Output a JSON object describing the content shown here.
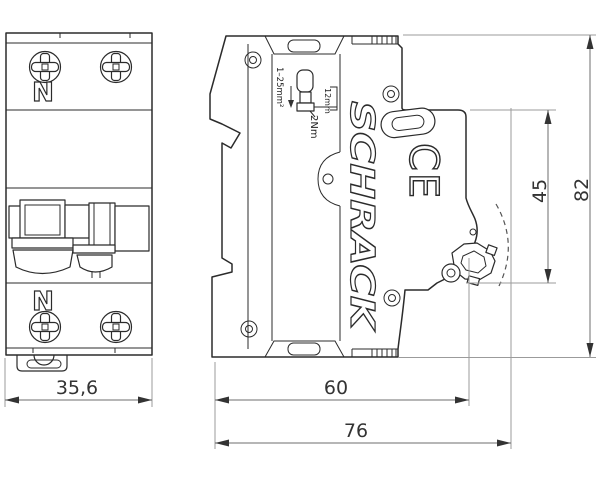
{
  "front_view": {
    "neutral_top": "N",
    "neutral_bottom": "N",
    "width_dim": "35,6"
  },
  "side_view": {
    "brand_logo": "SCHRACK",
    "ce_mark": "CE",
    "wire_range": "1–25mm²",
    "strip_length": "12mm",
    "torque": "2Nm",
    "body_depth_dim": "60",
    "total_depth_dim": "76",
    "front_height_dim": "45",
    "total_height_dim": "82"
  },
  "colors": {
    "line": "#2b2b2b",
    "extension_line": "#9b9b9b",
    "dimension_text": "#333333",
    "background": "#ffffff"
  }
}
